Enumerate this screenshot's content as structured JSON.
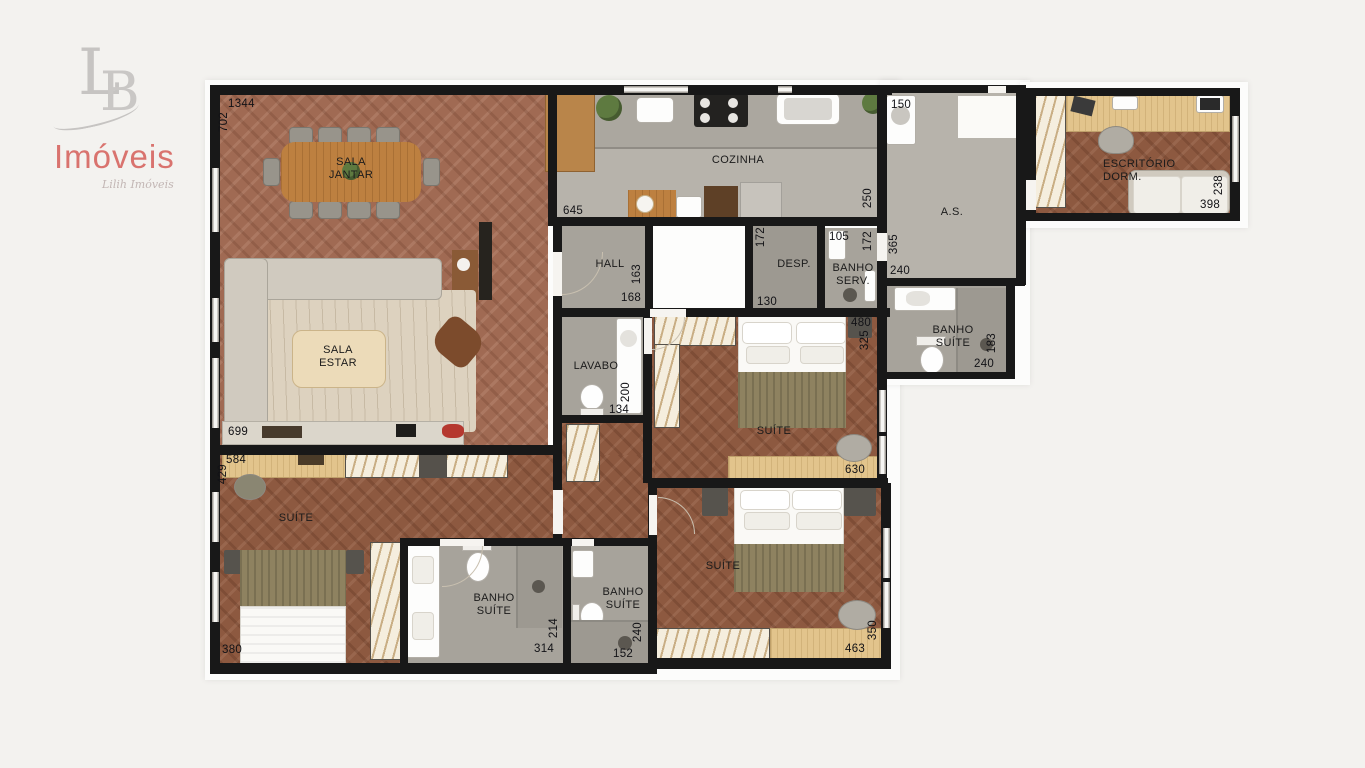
{
  "logo": {
    "monogram_l": "L",
    "monogram_b": "B",
    "brand": "Imóveis",
    "tagline": "Lilih Imóveis",
    "brand_color": "#d9736e",
    "monogram_color": "#c6c4c2"
  },
  "plan": {
    "living": {
      "dining_label": "SALA JANTAR",
      "living_label": "SALA ESTAR",
      "dim_top": "1344",
      "dim_left": "702",
      "dim_bottom": "699"
    },
    "kitchen": {
      "label": "COZINHA",
      "dim_left": "645",
      "dim_right": "250"
    },
    "hall": {
      "label": "HALL",
      "dim_h": "163",
      "dim_w": "168"
    },
    "desp": {
      "label": "DESP.",
      "dim_h": "172",
      "dim_w": "130"
    },
    "banho_serv": {
      "label": "BANHO SERV.",
      "dim_top": "105",
      "dim_h": "172"
    },
    "area_servico": {
      "label": "A.S.",
      "dim_top": "150",
      "dim_h": "365",
      "dim_w": "240"
    },
    "escritorio": {
      "label": "ESCRITÓRIO DORM.",
      "dim_h": "238",
      "dim_w": "398"
    },
    "banho_suite_master": {
      "label": "BANHO SUÍTE",
      "dim_h": "183",
      "dim_w": "240"
    },
    "lavabo": {
      "label": "LAVABO",
      "dim_h": "200",
      "dim_w": "134"
    },
    "suite_mid": {
      "label": "SUÍTE",
      "dim_top": "480",
      "dim_h": "325",
      "dim_bottom": "630"
    },
    "suite_left": {
      "label": "SUÍTE",
      "dim_top": "584",
      "dim_h": "429",
      "dim_bottom": "380"
    },
    "banho_suite_1": {
      "label": "BANHO SUÍTE",
      "dim_h": "214",
      "dim_w": "314"
    },
    "banho_suite_2": {
      "label": "BANHO SUÍTE",
      "dim_h": "240",
      "dim_w": "152"
    },
    "suite_bottom": {
      "label": "SUÍTE",
      "dim_w": "463",
      "dim_h": "350"
    }
  },
  "colors": {
    "wall": "#181818",
    "wood_floor": "#a06a53",
    "gray_floor": "#b7b3ab",
    "wood_furniture": "#bd8040",
    "hatch_stripe": "#c9ae84"
  }
}
